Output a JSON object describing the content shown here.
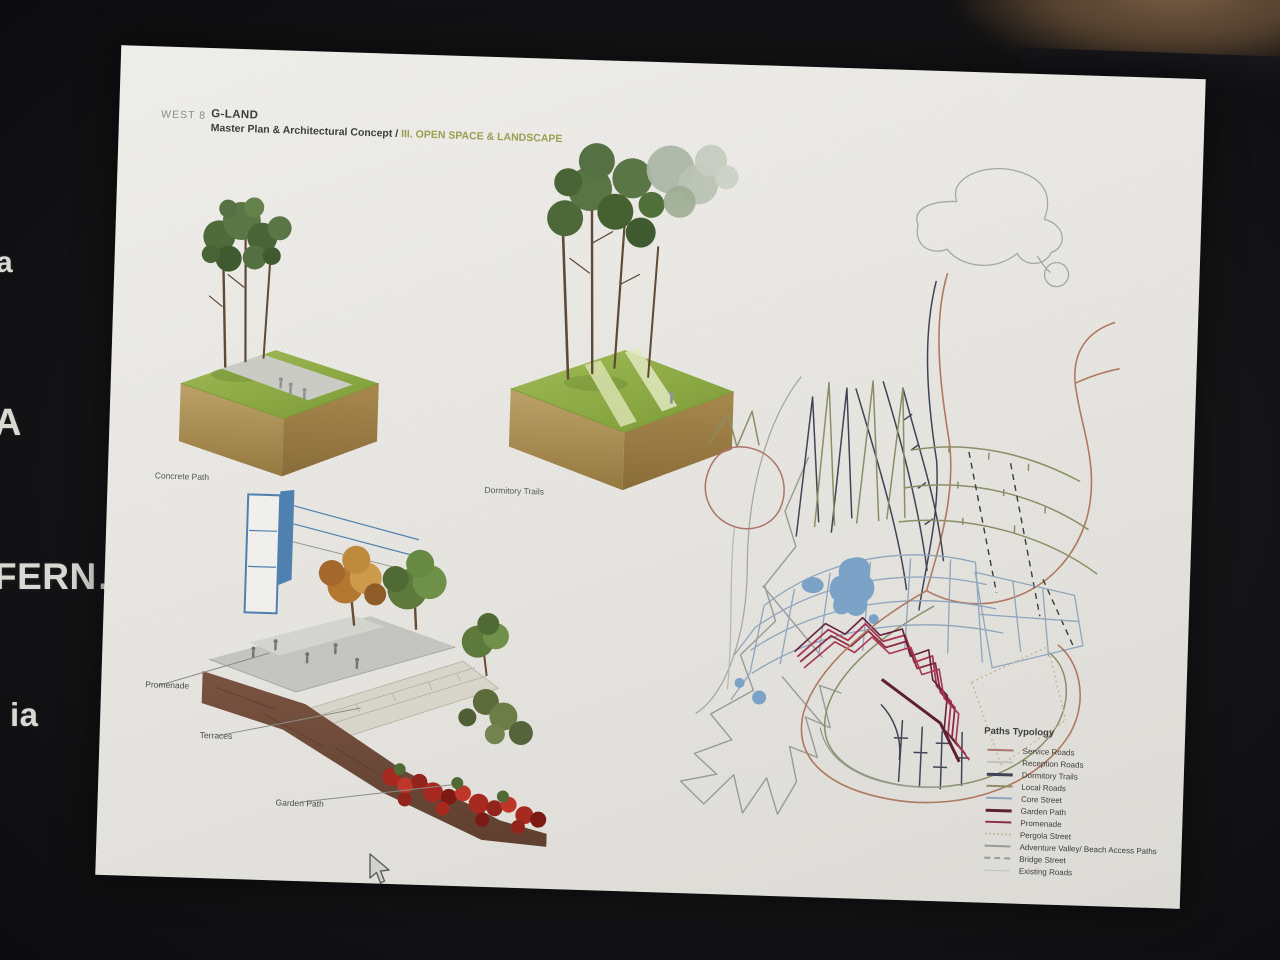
{
  "surroundings": {
    "fragments": [
      {
        "text": "a"
      },
      {
        "text": "A"
      },
      {
        "text": "FERN…"
      },
      {
        "text": "ia"
      }
    ]
  },
  "slide": {
    "header": {
      "studio": "WEST 8",
      "project": "G-LAND",
      "subtitle_prefix": "Master Plan & Architectural Concept / ",
      "subtitle_highlight": "III. OPEN SPACE & LANDSCAPE"
    },
    "figures": {
      "concrete_path": {
        "caption": "Concrete Path"
      },
      "dormitory_trails": {
        "caption": "Dormitory Trails"
      },
      "section": {
        "labels": {
          "promenade": "Promenade",
          "terraces": "Terraces",
          "garden_path": "Garden Path"
        }
      }
    },
    "legend": {
      "title": "Paths Typology",
      "items": [
        {
          "label": "Service Roads",
          "color": "#ad7468",
          "line_style": "solid",
          "weight": 2
        },
        {
          "label": "Reception Roads",
          "color": "#c3c3bd",
          "line_style": "solid",
          "weight": 2
        },
        {
          "label": "Dormitory Trails",
          "color": "#3f4354",
          "line_style": "solid",
          "weight": 3
        },
        {
          "label": "Local Roads",
          "color": "#8a8f66",
          "line_style": "solid",
          "weight": 2
        },
        {
          "label": "Core Street",
          "color": "#8fa6bd",
          "line_style": "solid",
          "weight": 2
        },
        {
          "label": "Garden Path",
          "color": "#5c1f32",
          "line_style": "solid",
          "weight": 3
        },
        {
          "label": "Promenade",
          "color": "#8c2a44",
          "line_style": "solid",
          "weight": 2
        },
        {
          "label": "Pergola Street",
          "color": "#c8bda0",
          "line_style": "dotted",
          "weight": 2
        },
        {
          "label": "Adventure Valley/ Beach Access Paths",
          "color": "#9b9b95",
          "line_style": "solid",
          "weight": 2
        },
        {
          "label": "Bridge Street",
          "color": "#9b9b95",
          "line_style": "dashed",
          "weight": 2
        },
        {
          "label": "Existing Roads",
          "color": "#c3c3bd",
          "line_style": "solid",
          "weight": 1
        }
      ]
    }
  },
  "colors": {
    "page_background": "#e9e7e2",
    "subtitle_highlight": "#9aa050",
    "header_text": "#3c3c38",
    "grass_green": "#8cab42",
    "soil_tan": "#b59a5f",
    "section_soil_brown": "#6f4a36",
    "building_blue": "#4f81b0",
    "garden_path_crimson": "#a93352",
    "service_road_brown": "#b0795f",
    "photo_background": "#151517"
  }
}
